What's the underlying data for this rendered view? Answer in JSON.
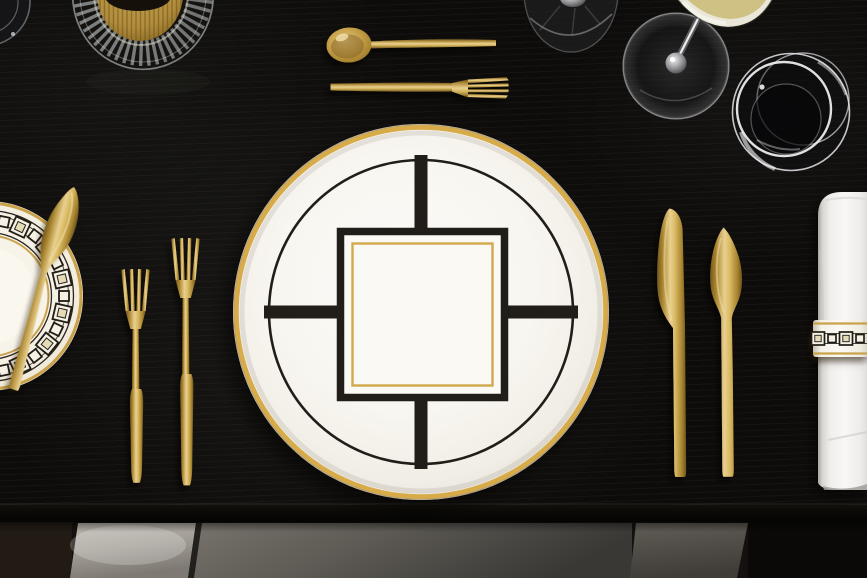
{
  "scene": {
    "type": "photograph",
    "description": "Overhead flat-lay of an elegant place setting on a black wooden table: white porcelain with black Art-Deco geometry and gold accents, matte gold cutlery, glassware and a rolled white napkin",
    "style": "art-deco tableware, black and gold",
    "counts": {
      "plates": 2,
      "gold_cutlery_pieces": 7,
      "forks": 3,
      "knives": 3,
      "spoons": 1,
      "glasses_visible": 5,
      "napkins": 1,
      "chairs_below_table": 3
    }
  },
  "objects": {
    "table": {
      "label": "Black wood dining table with horizontal grain"
    },
    "dinner_plate": {
      "label": "White dinner plate with gold rim, thin black circle and black square frame with gold inner line"
    },
    "bread_plate": {
      "label": "Bread plate with black-and-gold geometric chain border, partly out of frame"
    },
    "butter_knife": {
      "label": "Gold butter knife lying diagonally on the bread plate"
    },
    "starter_fork": {
      "label": "Gold starter fork left of the dinner plate"
    },
    "dinner_fork": {
      "label": "Gold dinner fork left of the dinner plate"
    },
    "dessert_spoon": {
      "label": "Gold dessert spoon above the dinner plate"
    },
    "dessert_fork": {
      "label": "Gold dessert fork above the dinner plate"
    },
    "dinner_knife": {
      "label": "Gold dinner knife right of the dinner plate"
    },
    "fish_knife": {
      "label": "Gold fish knife right of the dinner knife"
    },
    "napkin": {
      "label": "Rolled white damask napkin"
    },
    "napkin_ring": {
      "label": "Porcelain napkin ring with black geometric chain pattern and gold edges"
    },
    "water_tumbler": {
      "label": "Clear water tumbler seen from above"
    },
    "wine_glass": {
      "label": "Stemmed glass with white wine, bowl cut by top edge"
    },
    "glass_foot": {
      "label": "Dark foot of a second stemmed glass at top edge"
    },
    "crystal_tumbler": {
      "label": "Fluted crystal tumbler with golden drink at top left"
    },
    "edge_glass": {
      "label": "Partial glass at the top-left frame edge"
    },
    "chair_left": {
      "label": "Light grey upholstered chair below table"
    },
    "chair_middle": {
      "label": "Grey upholstered chair below table"
    },
    "chair_right": {
      "label": "Grey upholstered chair below table right"
    }
  },
  "palette": {
    "table_black": "#0d0c0a",
    "gold_light": "#e9d08f",
    "gold_mid": "#c49a45",
    "gold_dark": "#7c5f22",
    "gold_rim": "#d8ab49",
    "bread_gold": "#c9a24b",
    "porcelain": "#f8f6f0",
    "pattern_black": "#211d18",
    "band_ivory": "#f5f1e4",
    "beige_square": "#e6dbb7",
    "napkin_white": "#f4f3f1",
    "wine": "#cfc083",
    "chair_light": "#b6b0a8",
    "chair_mid": "#6f6b64",
    "chair_dark": "#474440",
    "floor_dark": "#161310"
  }
}
